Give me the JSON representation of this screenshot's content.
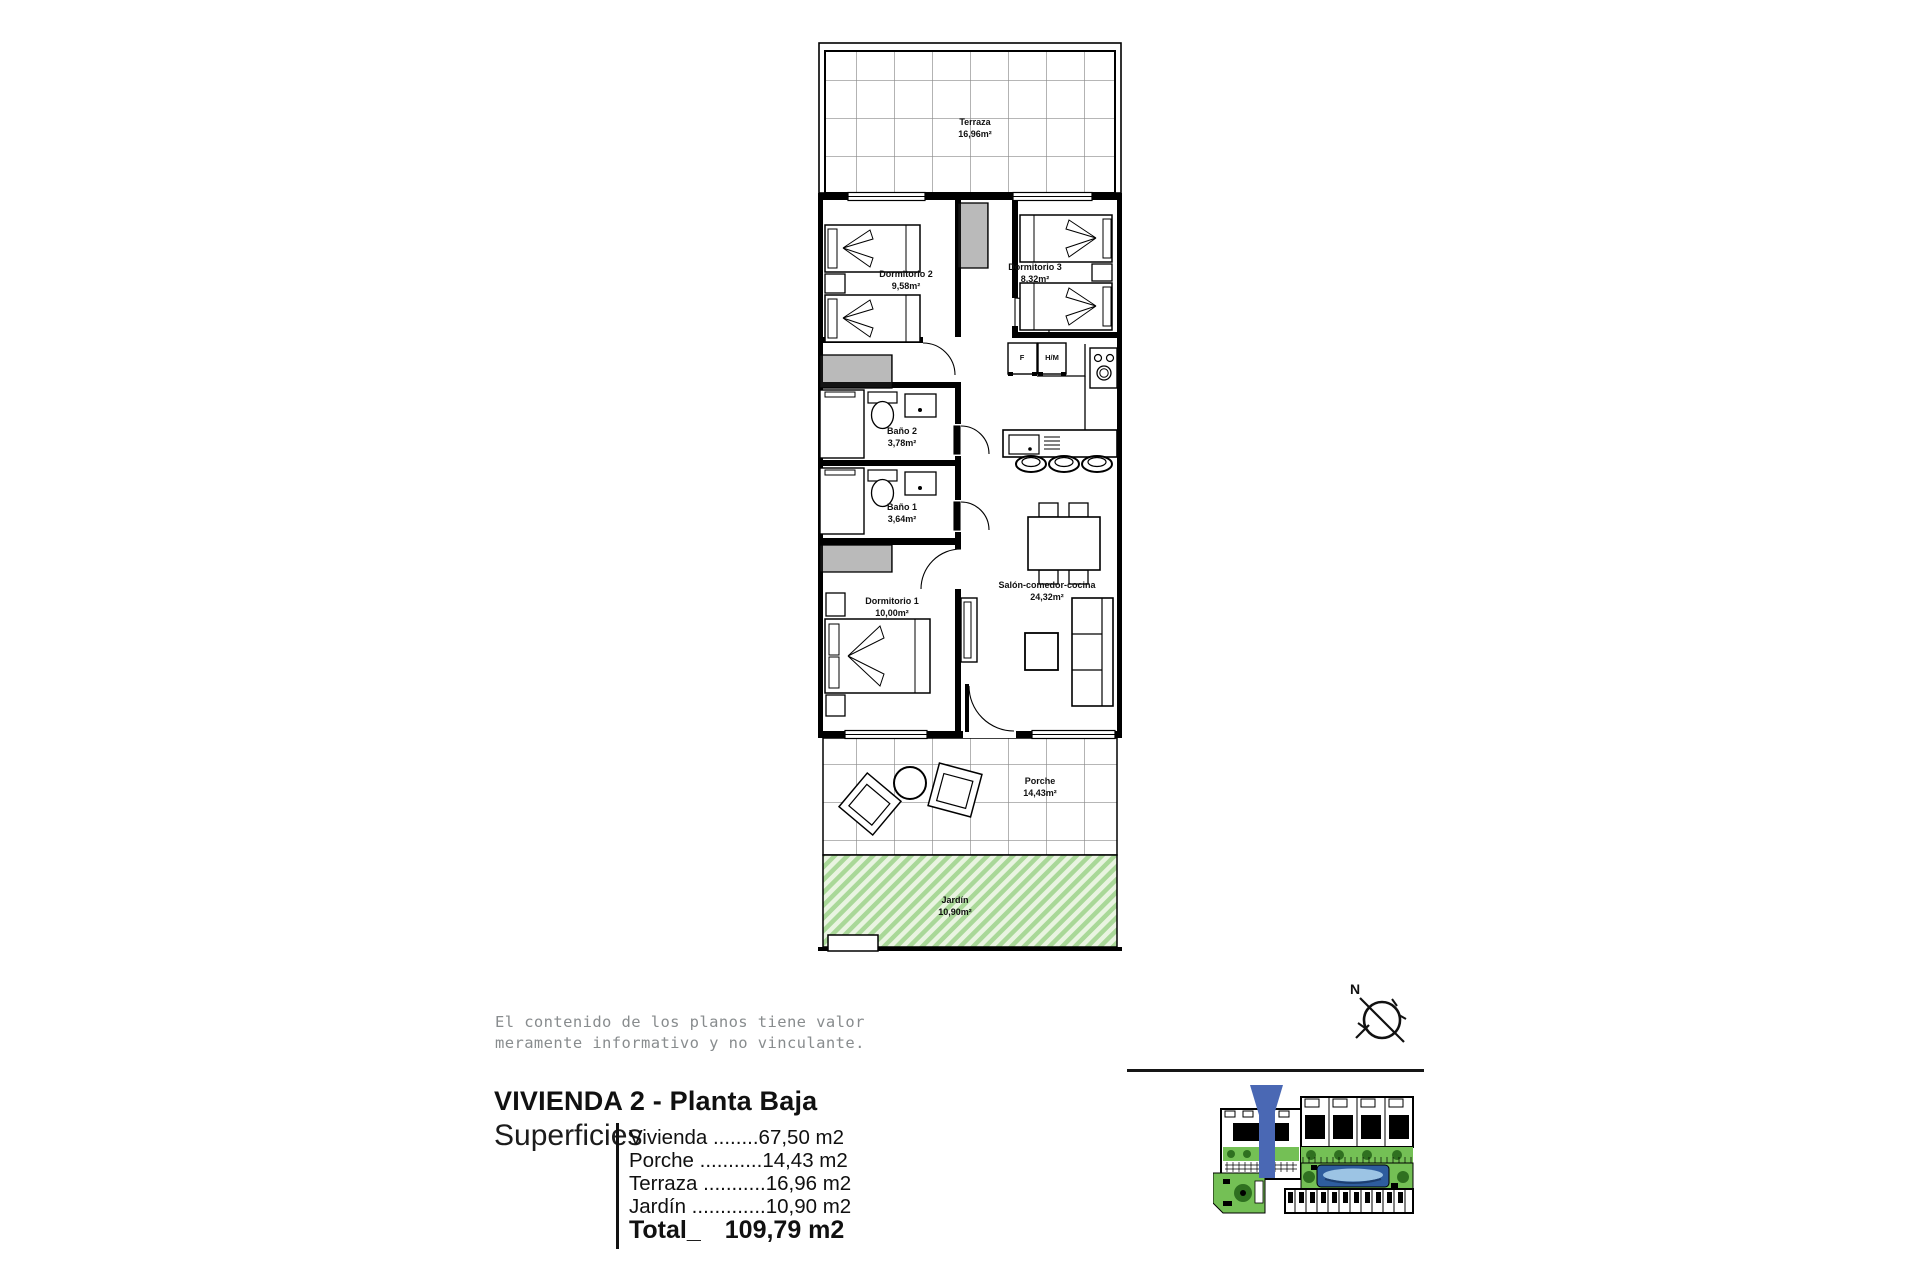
{
  "plan": {
    "rooms": [
      {
        "id": "terraza",
        "name": "Terraza",
        "area": "16,96m²"
      },
      {
        "id": "dormitorio2",
        "name": "Dormitorio 2",
        "area": "9,58m²"
      },
      {
        "id": "dormitorio3",
        "name": "Dormitorio 3",
        "area": "8,32m²"
      },
      {
        "id": "bano2",
        "name": "Baño 2",
        "area": "3,78m²"
      },
      {
        "id": "bano1",
        "name": "Baño 1",
        "area": "3,64m²"
      },
      {
        "id": "dormitorio1",
        "name": "Dormitorio 1",
        "area": "10,00m²"
      },
      {
        "id": "salon",
        "name": "Salón-comedor-cocina",
        "area": "24,32m²"
      },
      {
        "id": "porche",
        "name": "Porche",
        "area": "14,43m²"
      },
      {
        "id": "jardin",
        "name": "Jardín",
        "area": "10,90m²"
      }
    ],
    "appliances": {
      "fridge": "F",
      "washer": "H/M"
    }
  },
  "disclaimer": {
    "line1": "El contenido de los planos tiene valor",
    "line2": "meramente informativo y no vinculante."
  },
  "title_block": {
    "title": "VIVIENDA 2 - Planta Baja",
    "superficies_label": "Superficies",
    "rows": [
      {
        "label": "Vivienda ",
        "dots": "........",
        "value": "67,50 m2"
      },
      {
        "label": "Porche ",
        "dots": "...........",
        "value": "14,43 m2"
      },
      {
        "label": "Terraza ",
        "dots": "...........",
        "value": "16,96 m2"
      },
      {
        "label": "Jardín ",
        "dots": ".............",
        "value": "10,90 m2"
      }
    ],
    "total_label": "Total_",
    "total_value": "109,79 m2"
  },
  "compass": {
    "north_label": "N"
  },
  "colors": {
    "garden_light": "#e9f4e1",
    "garden_stripe": "#a9d898",
    "arrow_blue": "#4a68b4",
    "site_green": "#74c055",
    "site_tree_green": "#2f7020",
    "pool_blue": "#2e5d9e",
    "disclaimer_gray": "#888c8e"
  }
}
